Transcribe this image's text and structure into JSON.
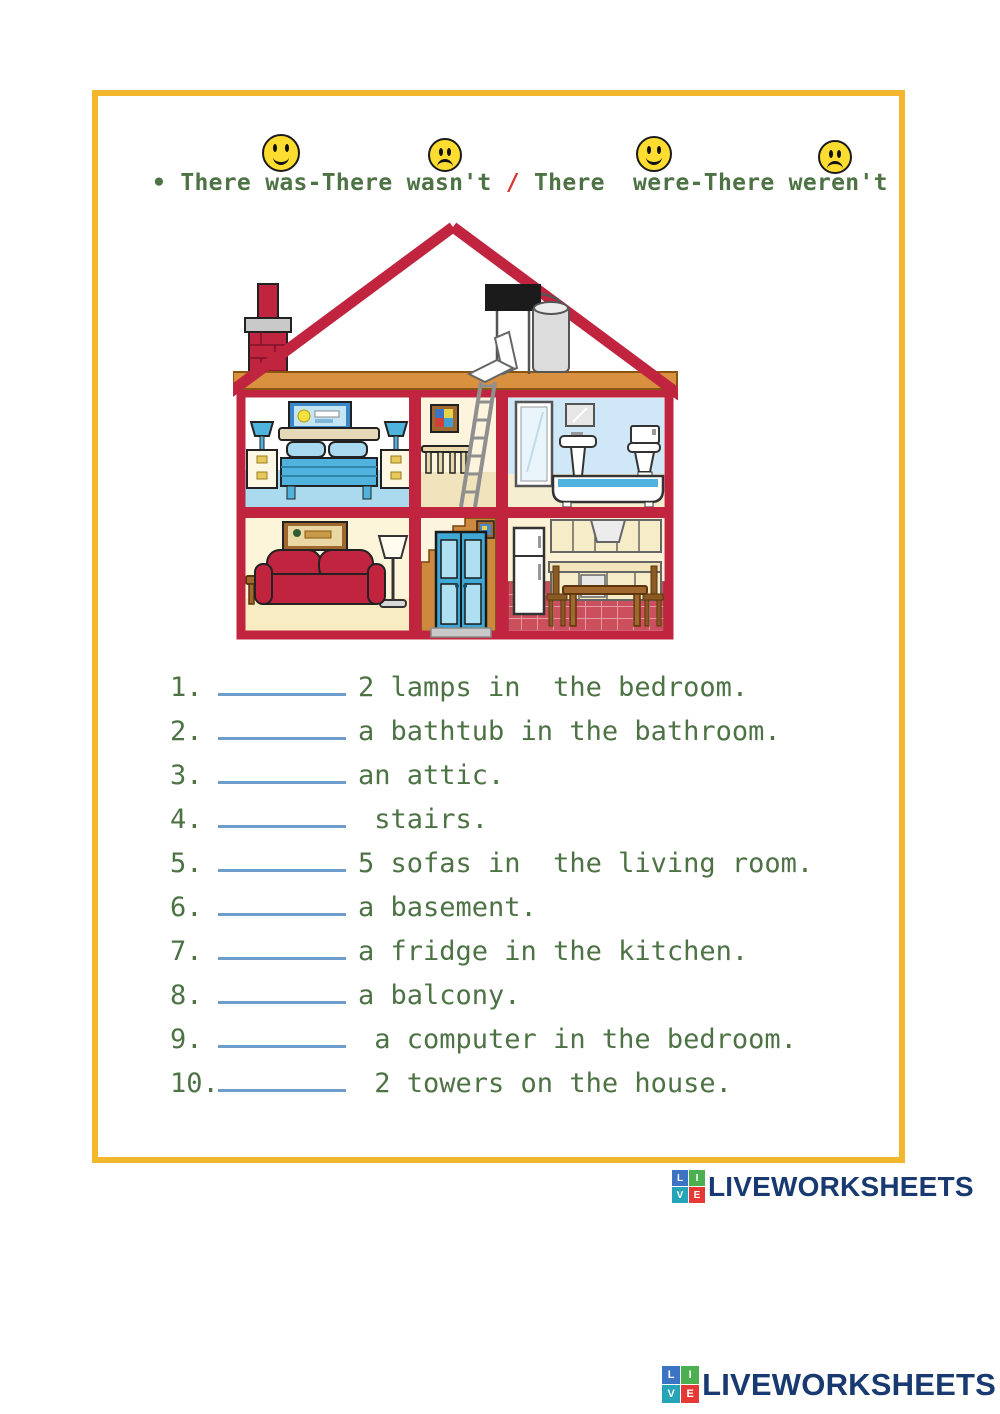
{
  "header": {
    "bullet": "•",
    "phrase_was": "There was-There wasn't",
    "slash": "/",
    "phrase_were": "There  were-There weren't",
    "faces": [
      "happy",
      "sad",
      "happy",
      "sad"
    ]
  },
  "exercise": {
    "items": [
      {
        "num": "1.",
        "text": "2 lamps in  the bedroom."
      },
      {
        "num": "2.",
        "text": "a bathtub in the bathroom."
      },
      {
        "num": "3.",
        "text": "an attic."
      },
      {
        "num": "4.",
        "text": " stairs."
      },
      {
        "num": "5.",
        "text": "5 sofas in  the living room."
      },
      {
        "num": "6.",
        "text": "a basement."
      },
      {
        "num": "7.",
        "text": "a fridge in the kitchen."
      },
      {
        "num": "8.",
        "text": "a balcony."
      },
      {
        "num": "9.",
        "text": " a computer in the bedroom."
      },
      {
        "num": "10.",
        "text": " 2 towers on the house."
      }
    ]
  },
  "illustration": "cross-section-house",
  "branding": {
    "logo_text": "LIVEWORKSHEETS",
    "squares": [
      {
        "letter": "L",
        "color": "#3b74c4"
      },
      {
        "letter": "I",
        "color": "#4caf50"
      },
      {
        "letter": "V",
        "color": "#26a5b8"
      },
      {
        "letter": "E",
        "color": "#e53935"
      }
    ]
  },
  "colors": {
    "border_yellow": "#f2b72c",
    "text_green": "#4d7345",
    "slash_red": "#d03a2c",
    "blank_blue": "#6f9dcb",
    "logo_navy": "#183a70",
    "roof_red": "#c1243f",
    "attic_floor_tan": "#d9913f",
    "smiley_yellow": "#ffdd30"
  }
}
